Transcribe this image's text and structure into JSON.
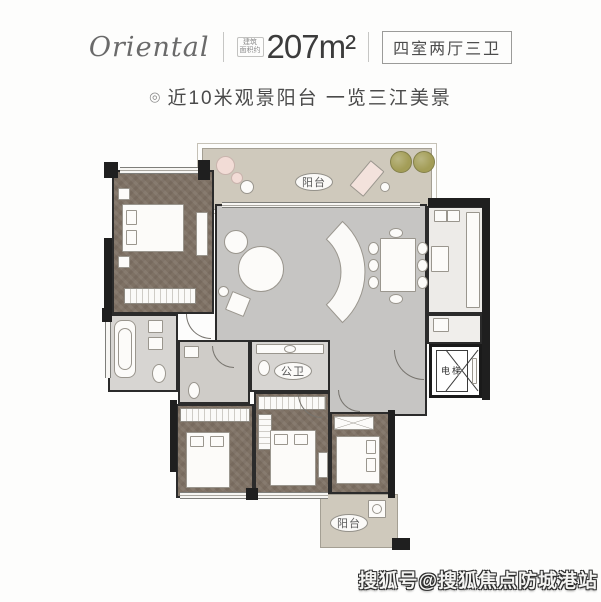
{
  "header": {
    "brand": "Oriental",
    "area_prefix_line1": "建筑",
    "area_prefix_line2": "面积约",
    "area": "207m²",
    "layout_box": "四室两厅三卫"
  },
  "subtitle": {
    "bullet": "◎",
    "text": "近10米观景阳台 一览三江美景"
  },
  "plan": {
    "labels": {
      "balcony_top": "阳台",
      "public_bath": "公卫",
      "elevator": "电梯",
      "balcony_bottom": "阳台"
    },
    "colors": {
      "wall": "#1f1f1f",
      "bedroom_floor": "#7e7164",
      "living_floor": "#c6c5c3",
      "balcony_floor": "#cfc9bc",
      "bath_floor": "#d7d5d2",
      "kitchen_floor": "#edebe8"
    }
  },
  "watermark": "搜狐号@搜狐焦点防城港站"
}
